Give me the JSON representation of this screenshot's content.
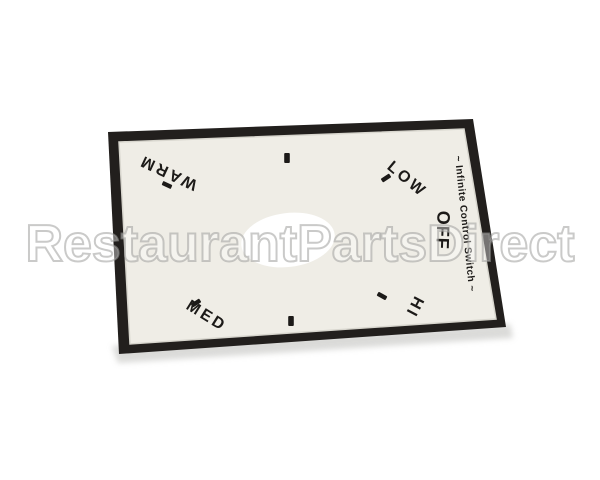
{
  "watermark": {
    "text": "RestaurantPartsDirect"
  },
  "decal": {
    "title": "~ Infinite Control Switch ~",
    "labels": {
      "off": "OFF",
      "low": "LOW",
      "warm": "WARM",
      "med": "MED",
      "hi": "HI"
    },
    "colors": {
      "border": "#221f1d",
      "face": "#efede6",
      "edge_highlight": "#d8d6ce",
      "hole": "#ffffff",
      "ink": "#1c1a18",
      "background": "#ffffff"
    }
  }
}
